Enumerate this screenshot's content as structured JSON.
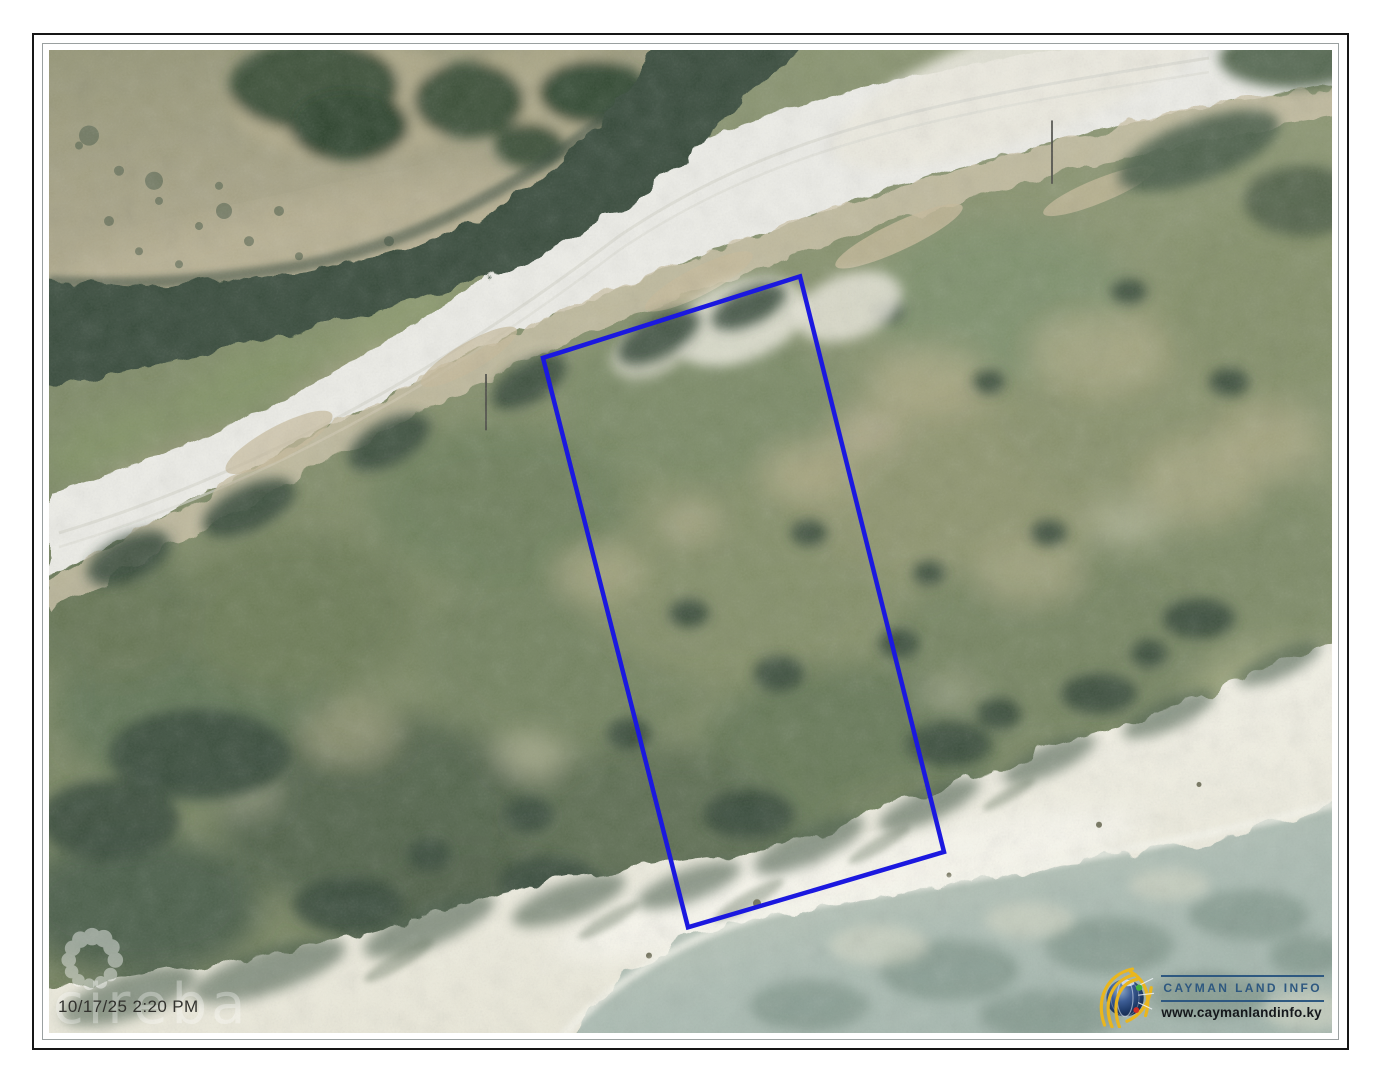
{
  "map": {
    "timestamp": "10/17/25 2:20 PM",
    "watermark": "cireba",
    "parcel": {
      "points": "751,225 494,306 639,872 895,797",
      "stroke_color": "#1b18df"
    }
  },
  "branding": {
    "title": "CAYMAN LAND INFO",
    "website": "www.caymanlandinfo.ky",
    "title_color": "#2e5880",
    "accent_gold": "#eab61d"
  }
}
